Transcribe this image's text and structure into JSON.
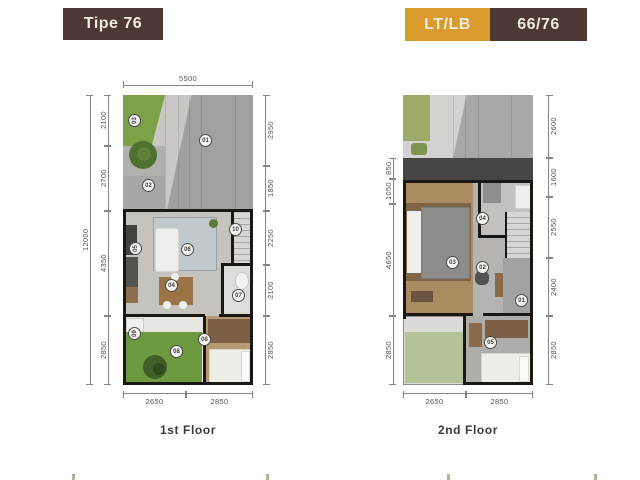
{
  "header": {
    "type_badge": "Tipe 76",
    "lt_lb_label": "LT/LB",
    "lt_lb_value": "66/76"
  },
  "colors": {
    "badge_brown": "#4e3833",
    "badge_orange": "#d99b2e",
    "badge_text": "#f4ecdf",
    "dim_text": "#555555",
    "wall": "#1a1715",
    "grass": "#6d9940",
    "pale_grass": "#b5c196"
  },
  "floors": {
    "floor1": {
      "caption": "1st Floor",
      "dim_top": "5500",
      "dim_overall_left": "12000",
      "dims_left": [
        "2100",
        "2700",
        "4350",
        "2850"
      ],
      "dims_right": [
        "2950",
        "1850",
        "2250",
        "2100",
        "2850"
      ],
      "dims_bottom": [
        "2650",
        "2850"
      ],
      "markers": [
        "03",
        "01",
        "02",
        "05",
        "06",
        "10",
        "04",
        "07",
        "09",
        "08",
        "08"
      ]
    },
    "floor2": {
      "caption": "2nd Floor",
      "dims_left": [
        "850",
        "1050",
        "4650",
        "2850"
      ],
      "dims_right": [
        "2600",
        "1600",
        "2550",
        "2400",
        "2850"
      ],
      "dims_bottom": [
        "2650",
        "2850"
      ],
      "markers": [
        "04",
        "03",
        "02",
        "01",
        "05"
      ]
    }
  }
}
